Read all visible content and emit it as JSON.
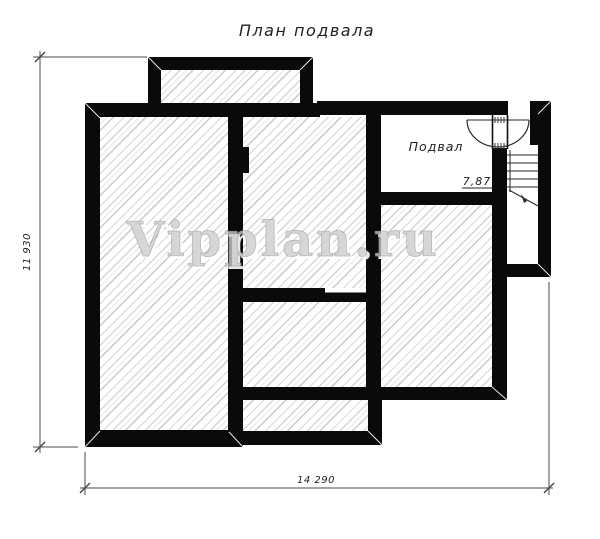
{
  "title": "План подвала",
  "watermark": "Vipplan.ru",
  "rooms": {
    "basement_label": "Подвал",
    "basement_area": "7,87"
  },
  "dimensions": {
    "height_total": "11 930",
    "width_total": "14 290"
  },
  "colors": {
    "background": "#ffffff",
    "wall": "#0a0a0a",
    "hatch_line": "#c9c9c9",
    "dimension_line": "#4a4a4a",
    "text": "#222222",
    "watermark_fill": "#cccccc",
    "watermark_outline": "#9e9e9e"
  }
}
